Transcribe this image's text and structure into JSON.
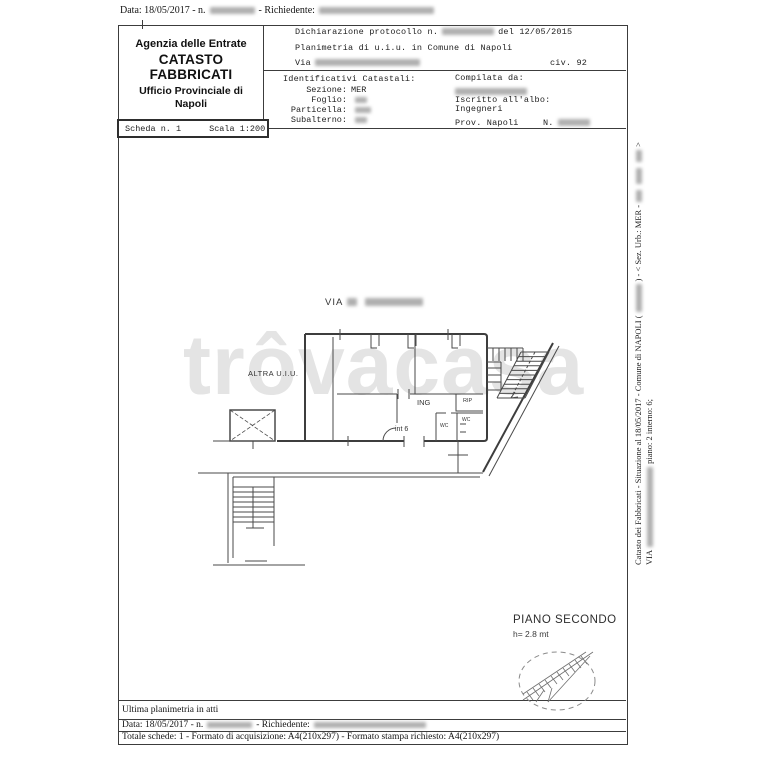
{
  "colors": {
    "ink": "#1c1c1c",
    "line": "#3c3c3c",
    "watermark": "#e4e4e4",
    "paper": "#ffffff"
  },
  "top_line": {
    "date_pre": "Data: 18/05/2017 - n.",
    "richiedente_label": "- Richiedente:"
  },
  "header": {
    "agency": [
      "Agenzia delle Entrate",
      "CATASTO FABBRICATI",
      "Ufficio Provinciale di",
      "Napoli"
    ],
    "scheda": "Scheda n. 1",
    "scala": "Scala 1:200",
    "dichiarazione_pre": "Dichiarazione protocollo n.",
    "dichiarazione_post": "del  12/05/2015",
    "planimetria": "Planimetria di u.i.u. in Comune di Napoli",
    "via_label": "Via",
    "civ": "civ. 92",
    "identificativi_title": "Identificativi Catastali:",
    "sezione_label": "Sezione:",
    "sezione_value": "MER",
    "foglio_label": "Foglio:",
    "particella_label": "Particella:",
    "subalterno_label": "Subalterno:",
    "compilata_label": "Compilata da:",
    "iscritto_label": "Iscritto all'albo:",
    "albo_value": "Ingegneri",
    "prov_label": "Prov. Napoli",
    "n_label": "N."
  },
  "plan": {
    "street_label": "VIA",
    "altra_uiu": "ALTRA U.I.U.",
    "ing": "ING",
    "rip": "RIP",
    "wc_1": "WC",
    "wc_2": "WC",
    "int6": "int 6",
    "piano": "PIANO SECONDO",
    "altezza": "h= 2.8 mt"
  },
  "watermark": "trôvacasa",
  "footer": {
    "ultima": "Ultima planimetria in atti",
    "data_pre": "Data: 18/05/2017 - n.",
    "richiedente_label": "- Richiedente:",
    "totale": "Totale schede: 1 - Formato di acquisizione: A4(210x297)  - Formato stampa richiesto: A4(210x297)"
  },
  "sidebar": {
    "line1_a": "Catasto dei Fabbricati - Situazione al 18/05/2017 - Comune di NAPOLI (",
    "line1_b": ") - < Sez. Urb.: MER -",
    "line1_c": ">",
    "line2_a": "VIA",
    "line2_b": "piano: 2 interno: 6;"
  }
}
